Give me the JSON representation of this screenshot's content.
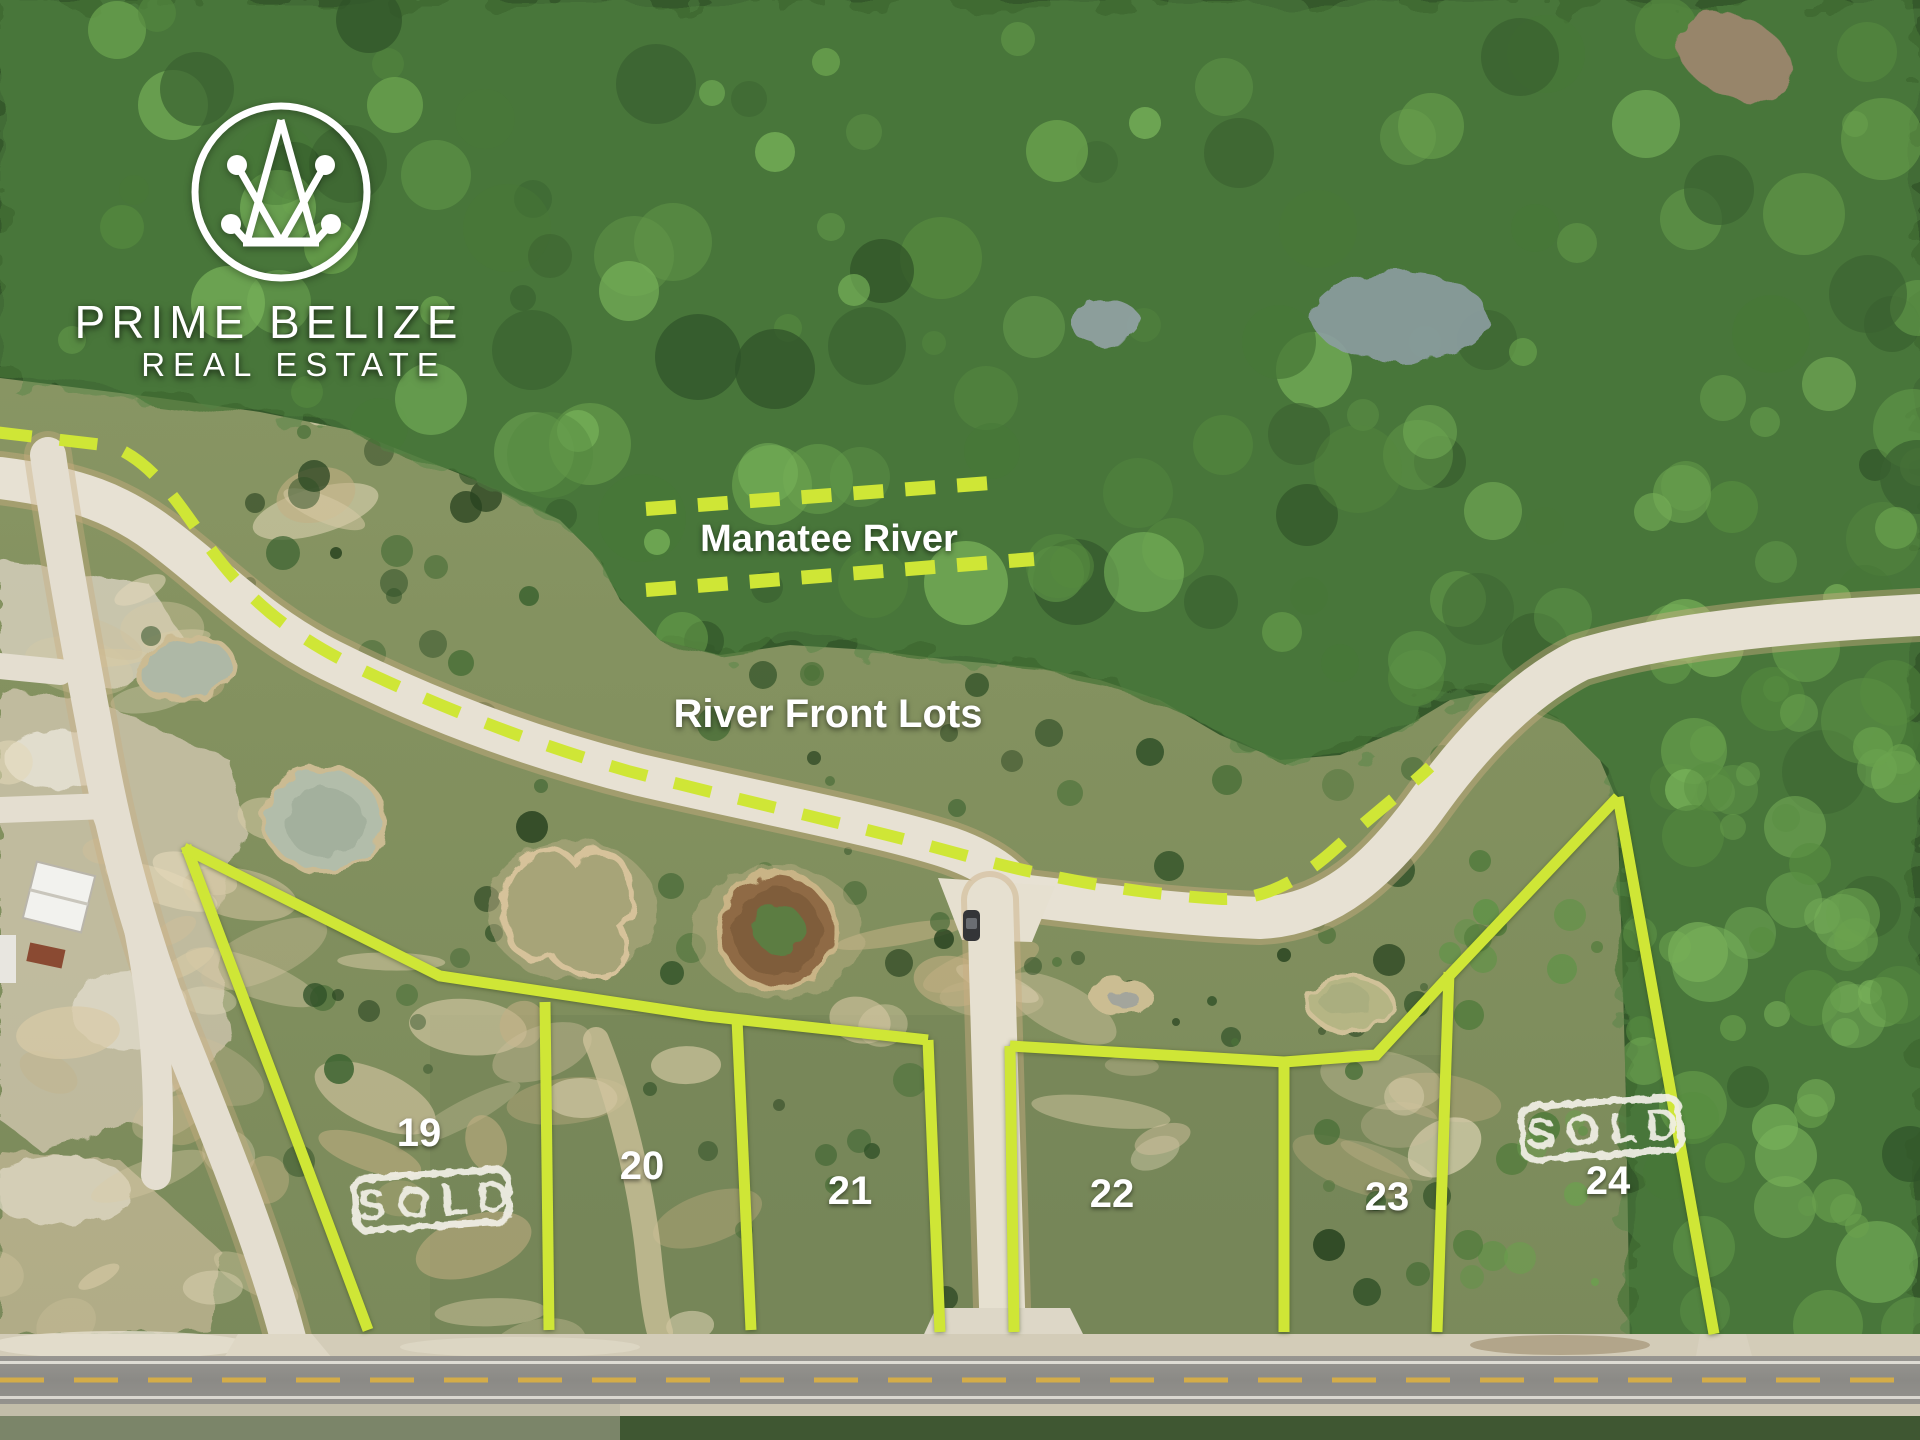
{
  "brand": {
    "line1": "PRIME BELIZE",
    "line2": "REAL ESTATE"
  },
  "annotations": {
    "river_label": "Manatee River",
    "area_label": "River Front Lots",
    "sold_label": "SOLD"
  },
  "lots": [
    {
      "number": "19",
      "sold": true
    },
    {
      "number": "20",
      "sold": false
    },
    {
      "number": "21",
      "sold": false
    },
    {
      "number": "22",
      "sold": false
    },
    {
      "number": "23",
      "sold": false
    },
    {
      "number": "24",
      "sold": true
    }
  ],
  "colors": {
    "boundary_line": "#cfe636",
    "dashed_line": "#cfe636",
    "label_text": "#ffffff",
    "sold_stamp": "#f1efe7"
  }
}
